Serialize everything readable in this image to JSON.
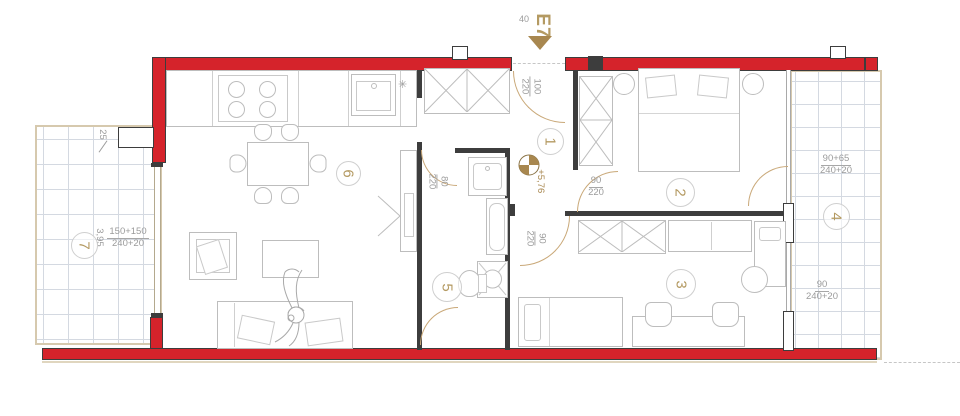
{
  "drawing": {
    "entrance": {
      "label": "E7",
      "width": "40"
    },
    "level": "+5,76",
    "rooms": {
      "r1": "1",
      "r2": "2",
      "r3": "3",
      "r4": "4",
      "r5": "5",
      "r6": "6",
      "r7": "7"
    },
    "doors": {
      "entrance": {
        "num": "100",
        "den": "220"
      },
      "bathroom": {
        "num": "80",
        "den": "220"
      },
      "room2": {
        "num": "90",
        "den": "220"
      },
      "room3": {
        "num": "90",
        "den": "220"
      }
    },
    "dims": {
      "balcony7_width": "25",
      "balcony7_len": {
        "num": "150+150",
        "den": "240+20"
      },
      "balcony7_depth": "3,95",
      "balcony4_a": {
        "num": "90+65",
        "den": "240+20"
      },
      "balcony4_b": {
        "num": "90",
        "den": "240+20"
      }
    },
    "symbols": {
      "appliance": "✳"
    }
  },
  "colors": {
    "wall_red": "#d5232b",
    "outline": "#3d3d3d",
    "accent_tan": "#b49a62",
    "dim_gray": "#9b9b9b",
    "door_tan": "#c9a878"
  }
}
